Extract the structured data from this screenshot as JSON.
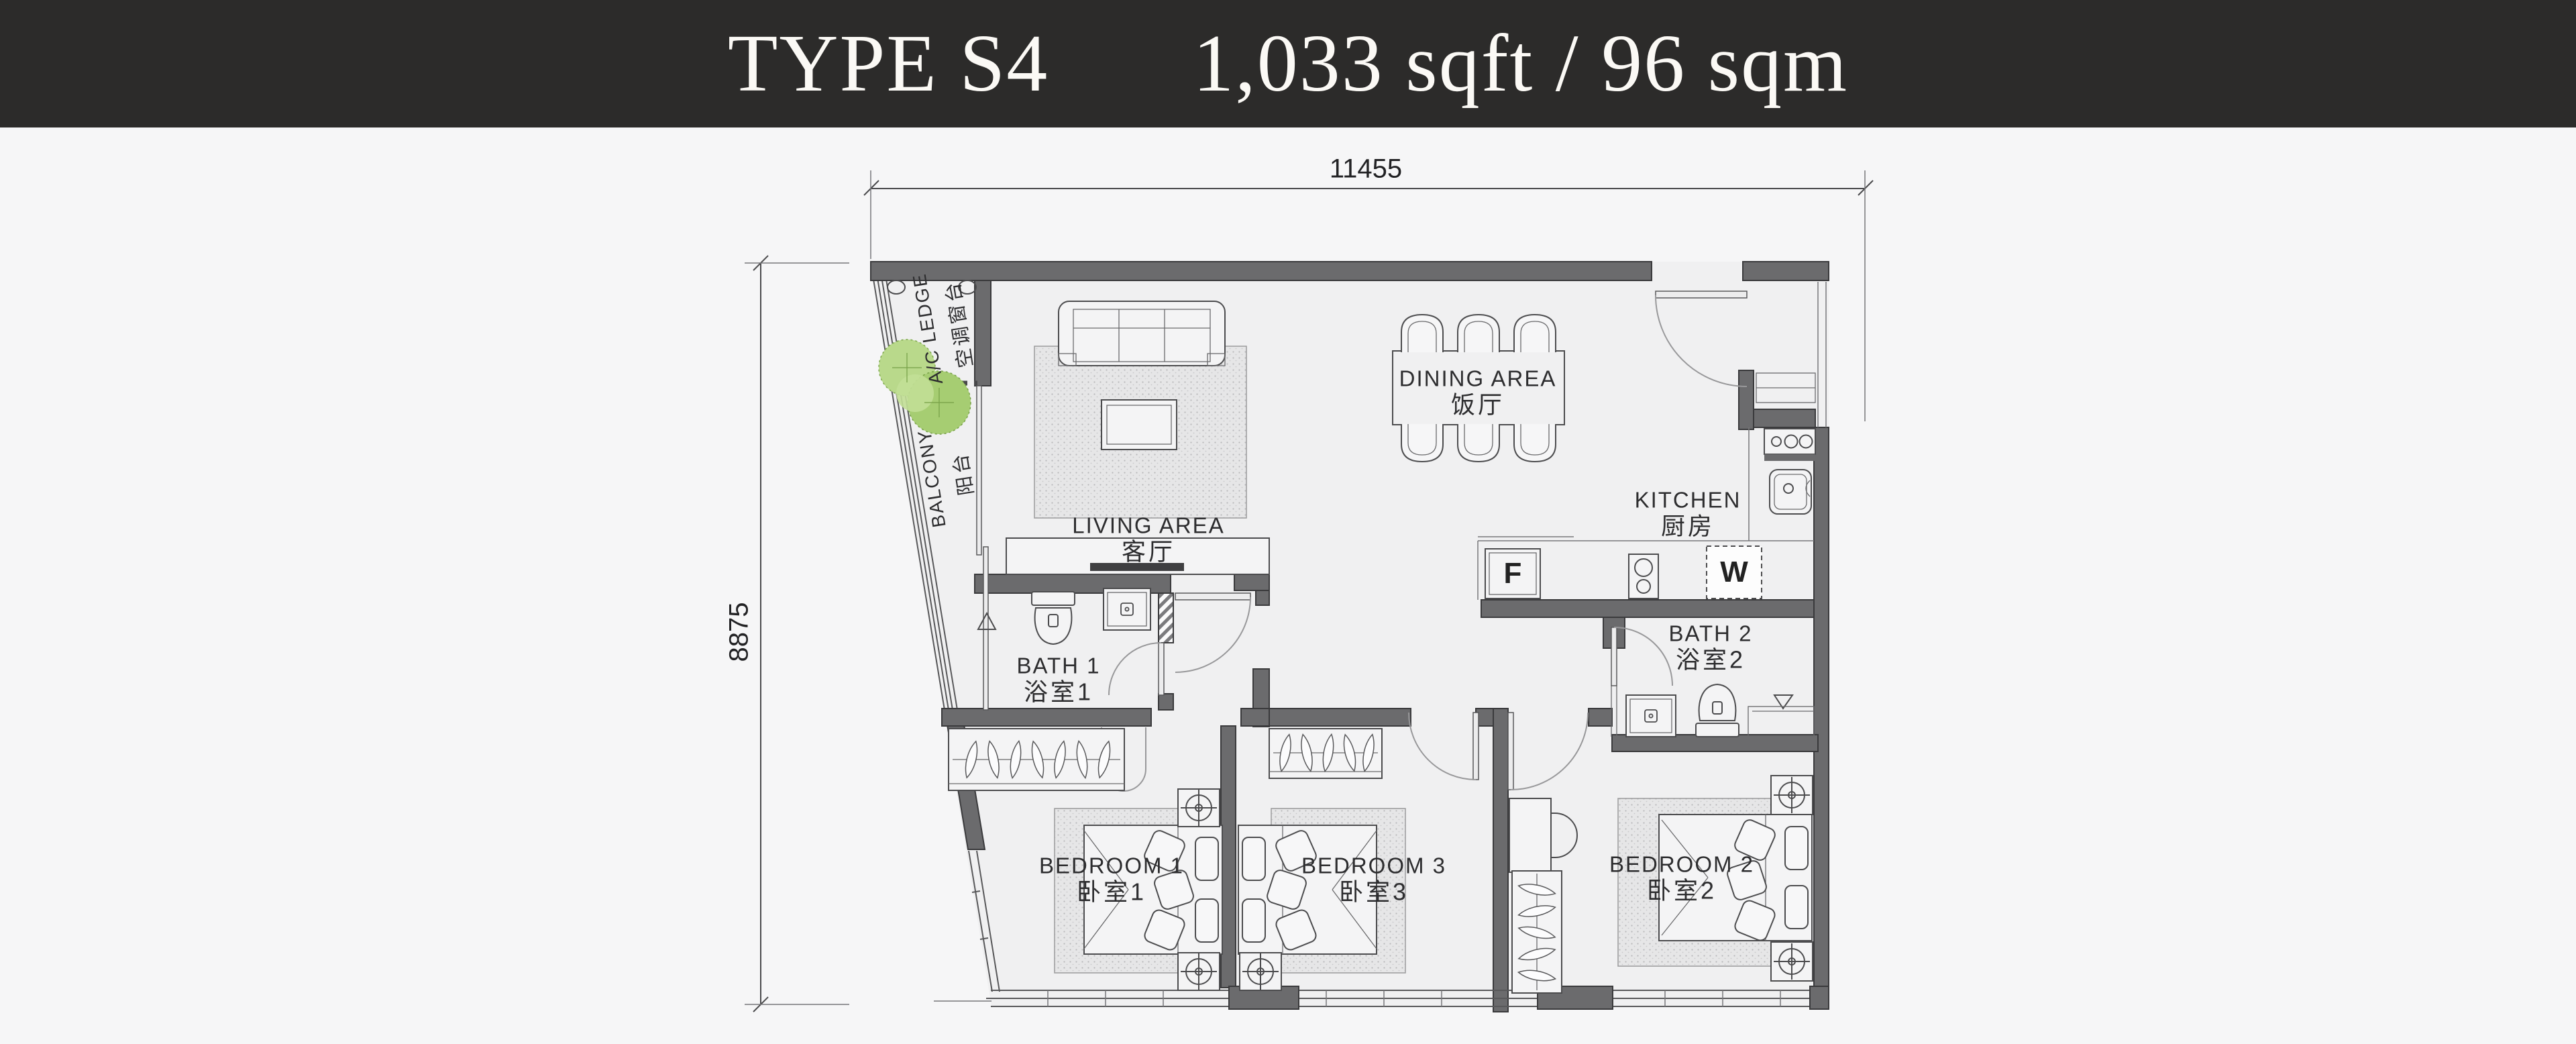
{
  "header": {
    "title": "TYPE S4",
    "area": "1,033 sqft / 96 sqm"
  },
  "dimensions": {
    "top": "11455",
    "left": "8875"
  },
  "rooms": {
    "ac_ledge": {
      "en": "A/C LEDGE",
      "zh": "空调窗台"
    },
    "balcony": {
      "en": "BALCONY",
      "zh": "阳台"
    },
    "living": {
      "en": "LIVING AREA",
      "zh": "客厅"
    },
    "dining": {
      "en": "DINING AREA",
      "zh": "饭厅"
    },
    "kitchen": {
      "en": "KITCHEN",
      "zh": "厨房"
    },
    "bath1": {
      "en": "BATH 1",
      "zh": "浴室1"
    },
    "bath2": {
      "en": "BATH 2",
      "zh": "浴室2"
    },
    "bedroom1": {
      "en": "BEDROOM 1",
      "zh": "卧室1"
    },
    "bedroom2": {
      "en": "BEDROOM 2",
      "zh": "卧室2"
    },
    "bedroom3": {
      "en": "BEDROOM 3",
      "zh": "卧室3"
    }
  },
  "appliances": {
    "fridge_label": "F",
    "washer_label": "W"
  },
  "colors": {
    "header_bg": "#2c2b2a",
    "header_text": "#fbf9f5",
    "wall_gray": "#6b6b6d",
    "line_gray": "#4c4c4e",
    "plant_green": "#a6cd72",
    "floor_fill": "#f0f0f1",
    "page_bg": "#f6f6f7"
  }
}
